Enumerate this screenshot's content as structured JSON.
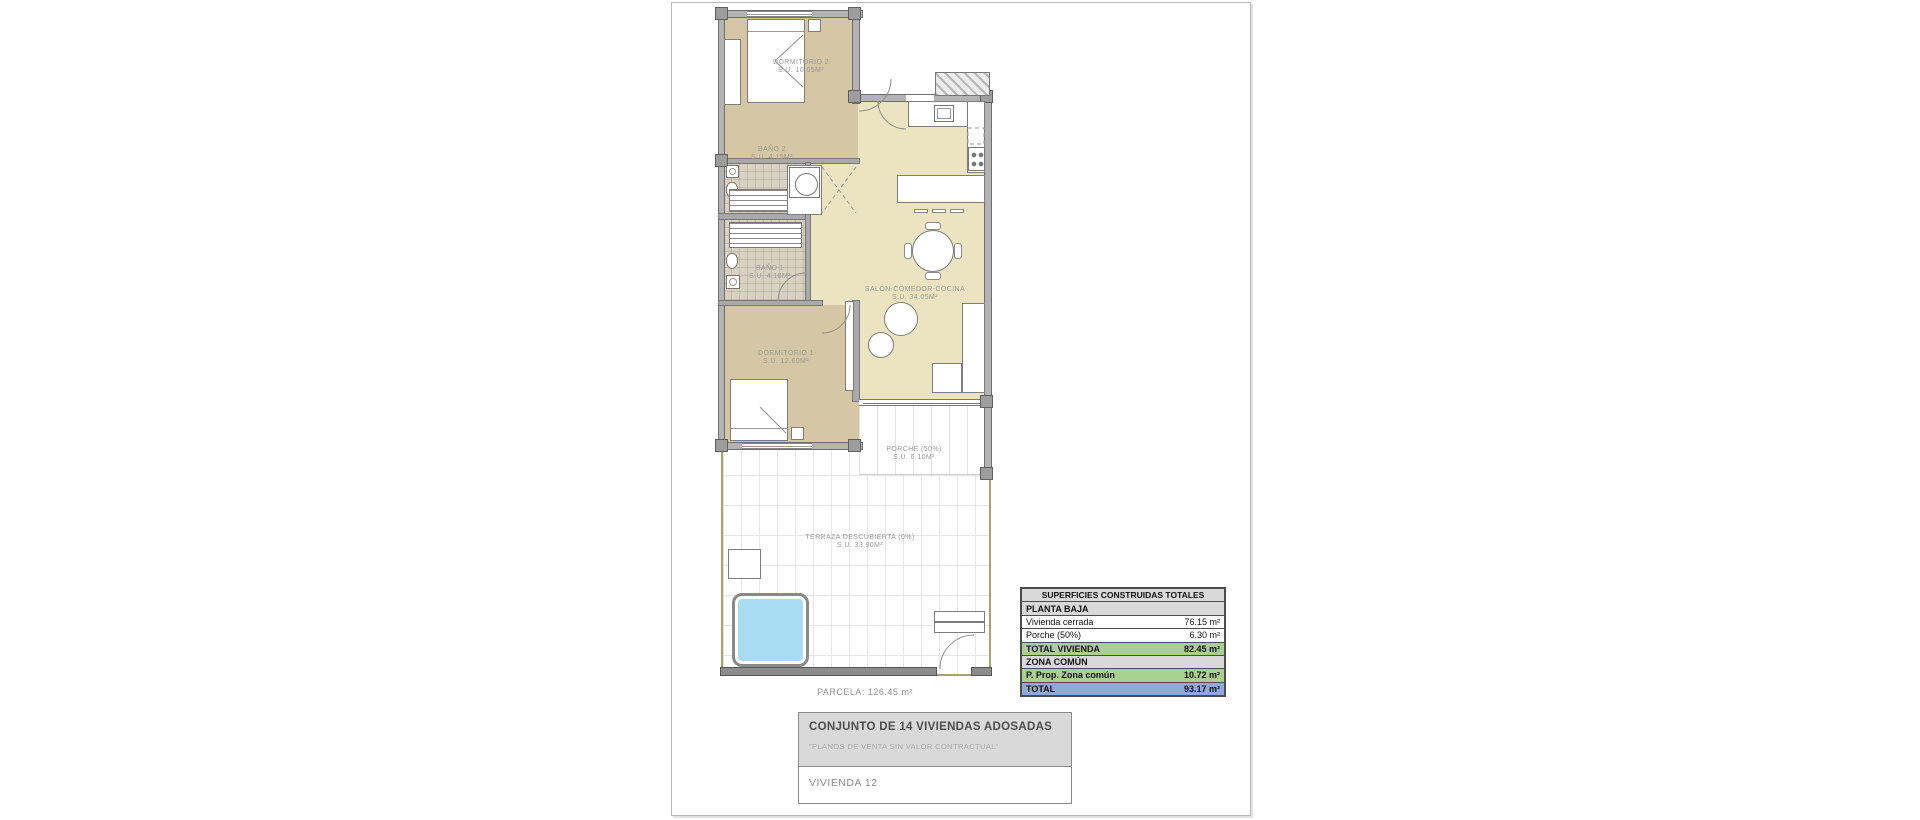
{
  "plan": {
    "rooms": [
      {
        "name": "DORMITORIO 2",
        "area": "S.U. 10.05m²"
      },
      {
        "name": "BAÑO 2",
        "area": "S.U. 4.15m²"
      },
      {
        "name": "BAÑO 1",
        "area": "S.U. 4.10m²"
      },
      {
        "name": "SALÓN-COMEDOR-COCINA",
        "area": "S.U. 34.05m²"
      },
      {
        "name": "DORMITORIO 1",
        "area": "S.U. 12.60m²"
      },
      {
        "name": "PORCHE (50%)",
        "area": "S.U. 6.10m²"
      },
      {
        "name": "TERRAZA DESCUBIERTA (0%)",
        "area": "S.U. 33.90m²"
      }
    ],
    "parcela_label": "PARCELA: 126.45 m²"
  },
  "surfaces_table": {
    "title": "SUPERFICIES CONSTRUIDAS TOTALES",
    "rows": [
      {
        "label": "PLANTA BAJA",
        "value": ""
      },
      {
        "label": "Vivienda cerrada",
        "value": "76.15 m²"
      },
      {
        "label": "Porche (50%)",
        "value": "6.30 m²"
      },
      {
        "label": "TOTAL VIVIENDA",
        "value": "82.45 m²"
      },
      {
        "label": "ZONA COMÚN",
        "value": ""
      },
      {
        "label": "P. Prop. Zona común",
        "value": "10.72 m²"
      },
      {
        "label": "TOTAL",
        "value": "93.17 m²"
      }
    ]
  },
  "title_block": {
    "project": "CONJUNTO DE 14 VIVIENDAS ADOSADAS",
    "disclaimer": "\"PLANOS DE VENTA SIN VALOR CONTRACTUAL\"",
    "unit": "VIVIENDA 12"
  },
  "colors": {
    "bedroom_floor": "#d5c6a4",
    "living_floor": "#ece4c0",
    "bathroom_floor": "#d9d2c2",
    "pool_water": "#a9dcf2",
    "wall_gray": "#b3b3b3",
    "parcel_line": "#a8a272",
    "table_header_bg": "#d9d9d9",
    "table_subtotal_bg": "#a9d08e",
    "table_total_bg": "#8eaadc"
  }
}
